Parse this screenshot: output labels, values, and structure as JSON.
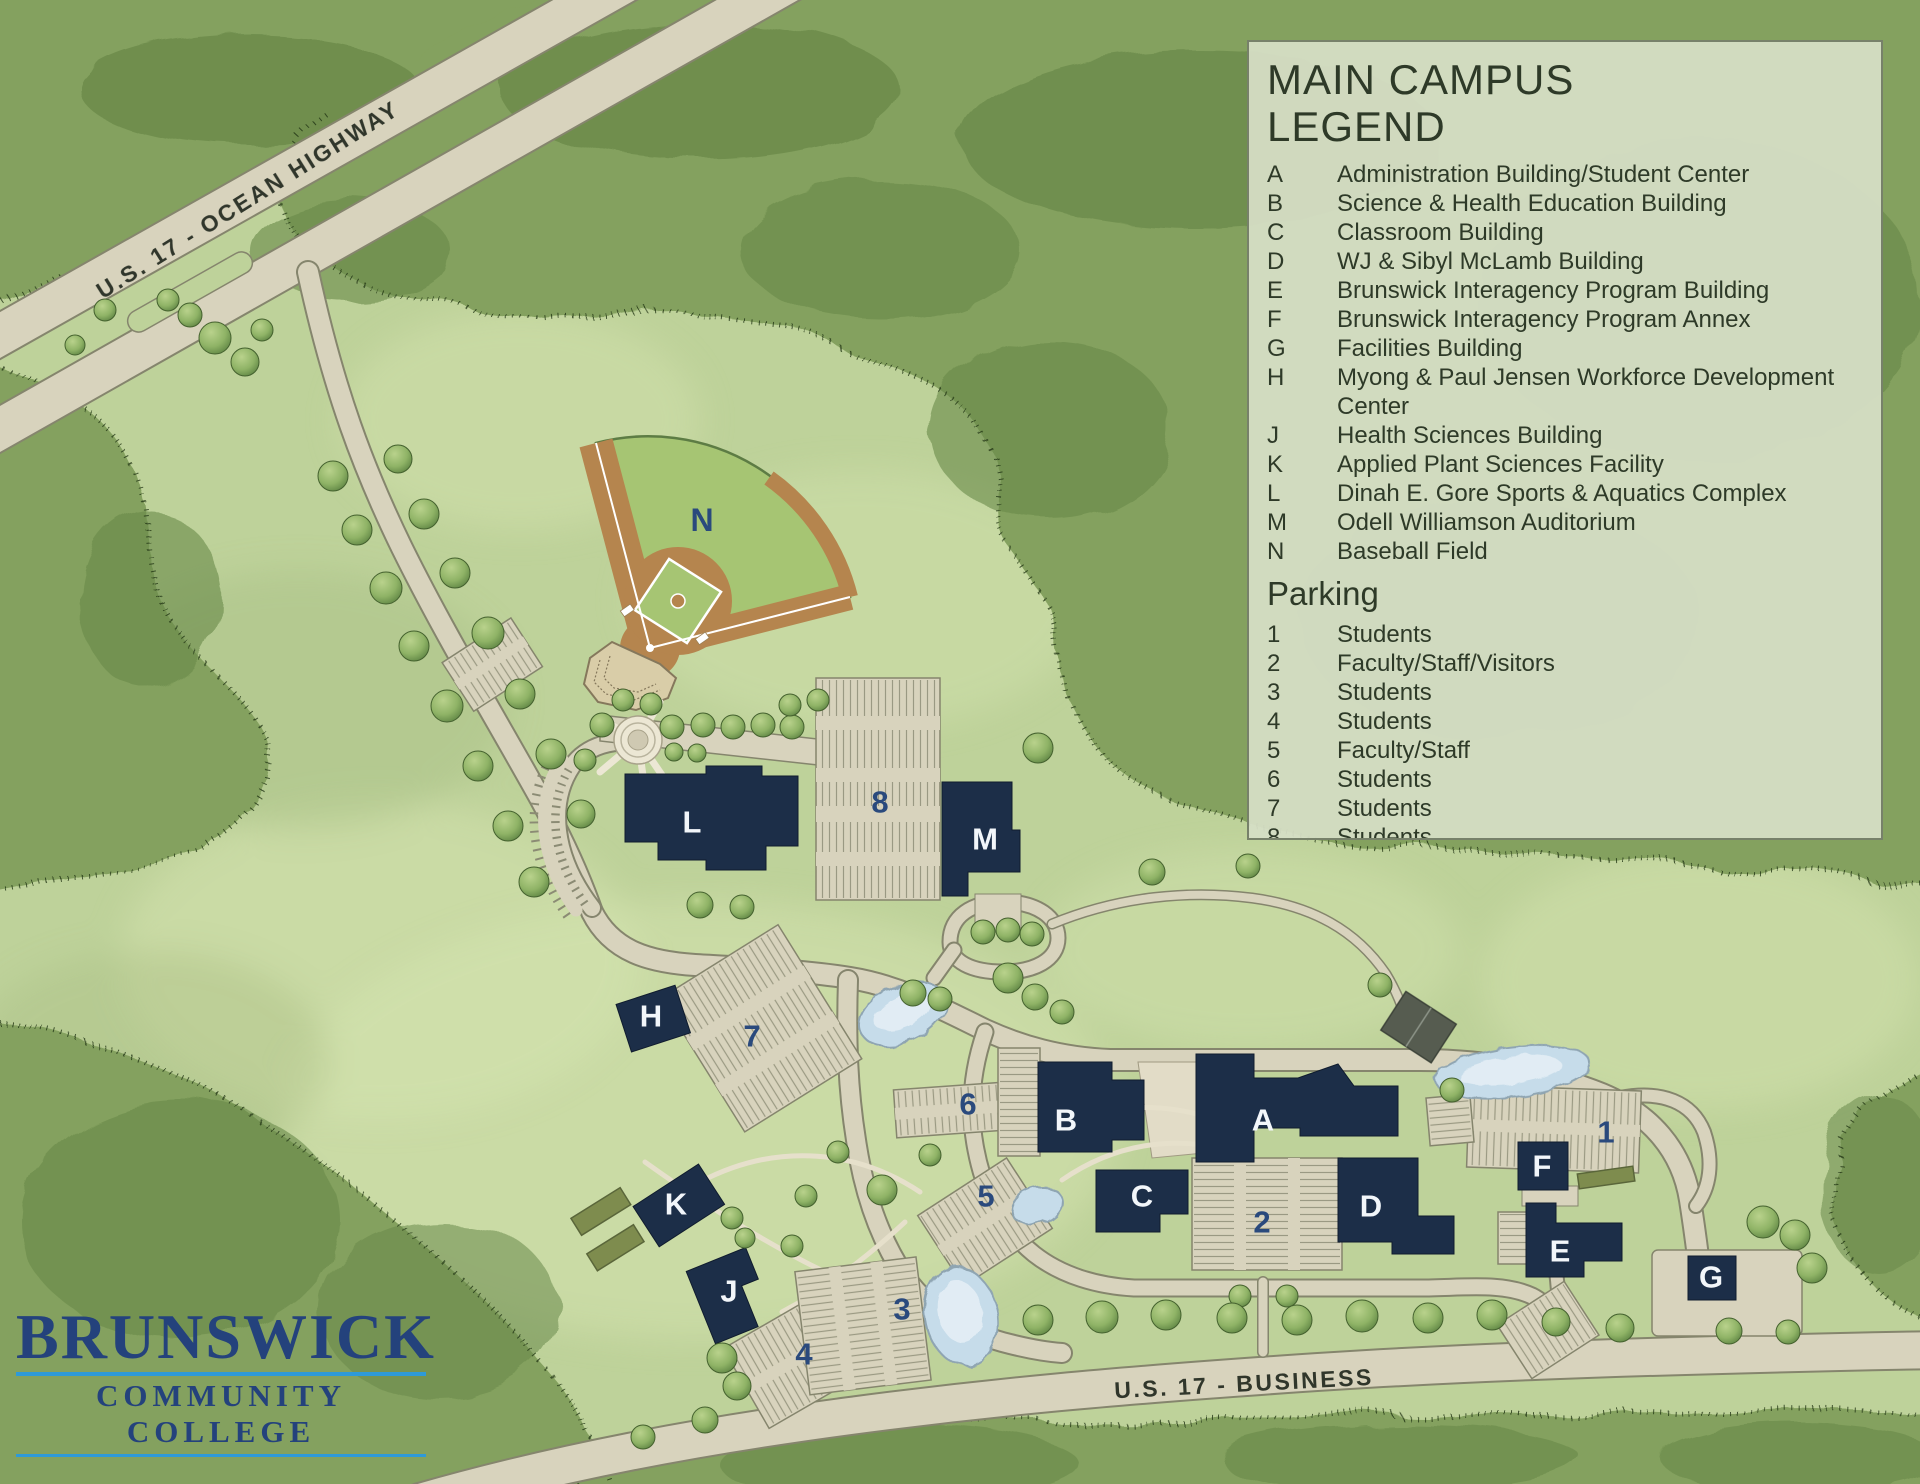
{
  "legend": {
    "title_line1": "MAIN CAMPUS",
    "title_line2": "LEGEND",
    "buildings": [
      {
        "key": "A",
        "name": "Administration Building/Student Center"
      },
      {
        "key": "B",
        "name": "Science & Health Education Building"
      },
      {
        "key": "C",
        "name": "Classroom Building"
      },
      {
        "key": "D",
        "name": "WJ & Sibyl McLamb Building"
      },
      {
        "key": "E",
        "name": "Brunswick Interagency Program Building"
      },
      {
        "key": "F",
        "name": "Brunswick Interagency Program Annex"
      },
      {
        "key": "G",
        "name": "Facilities Building"
      },
      {
        "key": "H",
        "name": "Myong & Paul Jensen Workforce Development Center"
      },
      {
        "key": "J",
        "name": "Health Sciences Building"
      },
      {
        "key": "K",
        "name": "Applied Plant Sciences Facility"
      },
      {
        "key": "L",
        "name": "Dinah E. Gore Sports & Aquatics Complex"
      },
      {
        "key": "M",
        "name": "Odell Williamson Auditorium"
      },
      {
        "key": "N",
        "name": "Baseball Field"
      }
    ],
    "parking_heading": "Parking",
    "parking": [
      {
        "key": "1",
        "name": "Students"
      },
      {
        "key": "2",
        "name": "Faculty/Staff/Visitors"
      },
      {
        "key": "3",
        "name": "Students"
      },
      {
        "key": "4",
        "name": "Students"
      },
      {
        "key": "5",
        "name": "Faculty/Staff"
      },
      {
        "key": "6",
        "name": "Students"
      },
      {
        "key": "7",
        "name": "Students"
      },
      {
        "key": "8",
        "name": "Students"
      }
    ]
  },
  "map": {
    "building_markers": [
      {
        "label": "A",
        "x": 1263,
        "y": 1120
      },
      {
        "label": "B",
        "x": 1066,
        "y": 1120
      },
      {
        "label": "C",
        "x": 1142,
        "y": 1196
      },
      {
        "label": "D",
        "x": 1371,
        "y": 1206
      },
      {
        "label": "E",
        "x": 1560,
        "y": 1251
      },
      {
        "label": "F",
        "x": 1542,
        "y": 1166
      },
      {
        "label": "G",
        "x": 1711,
        "y": 1277
      },
      {
        "label": "H",
        "x": 651,
        "y": 1016
      },
      {
        "label": "J",
        "x": 729,
        "y": 1291
      },
      {
        "label": "K",
        "x": 676,
        "y": 1204
      },
      {
        "label": "L",
        "x": 692,
        "y": 822
      },
      {
        "label": "M",
        "x": 985,
        "y": 839
      }
    ],
    "field_markers": [
      {
        "label": "N",
        "x": 702,
        "y": 520
      }
    ],
    "parking_markers": [
      {
        "label": "1",
        "x": 1606,
        "y": 1132
      },
      {
        "label": "2",
        "x": 1262,
        "y": 1222
      },
      {
        "label": "3",
        "x": 902,
        "y": 1309
      },
      {
        "label": "4",
        "x": 804,
        "y": 1354
      },
      {
        "label": "5",
        "x": 986,
        "y": 1196
      },
      {
        "label": "6",
        "x": 968,
        "y": 1104
      },
      {
        "label": "7",
        "x": 752,
        "y": 1036
      },
      {
        "label": "8",
        "x": 880,
        "y": 802
      }
    ],
    "road_labels": [
      {
        "id": "ocean-highway",
        "text": "U.S. 17 - OCEAN HIGHWAY",
        "x": 248,
        "y": 200,
        "rotation": -32
      },
      {
        "id": "business",
        "text": "U.S. 17 - BUSINESS",
        "x": 1244,
        "y": 1384,
        "rotation": -3
      }
    ],
    "colors": {
      "building": "#1c2e48",
      "road": "#d8d3bd",
      "forest": "#84a15e",
      "grass": "#bed29a",
      "water": "#c6dcea",
      "navy_text": "#2a4a7d",
      "accent_blue": "#2e9ad8"
    }
  },
  "logo": {
    "line1": "BRUNSWICK",
    "line2": "COMMUNITY COLLEGE"
  }
}
